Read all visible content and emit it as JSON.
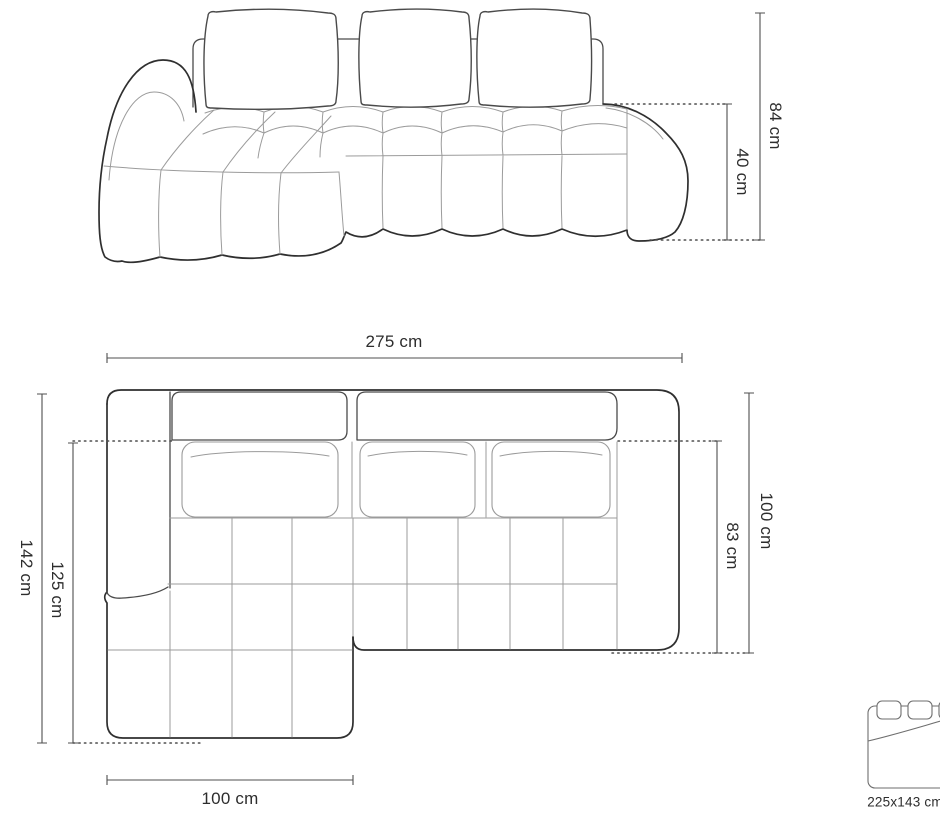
{
  "page": {
    "title": "Corner sofa dimensions diagram"
  },
  "colors": {
    "c-outline": "#2f2f2f",
    "c-outline-soft": "#4a4a4a",
    "c-seam": "#9b9b9b",
    "c-dim": "#4f4f4f",
    "c-text": "#2d2d2d",
    "c-bg": "#ffffff"
  },
  "front_view": {
    "name": "front-elevation-drawing",
    "dim_height_total": "84 cm",
    "dim_seat_height": "40 cm"
  },
  "top_view": {
    "name": "top-plan-drawing",
    "dim_width_total": "275 cm",
    "dim_depth_total": "142 cm",
    "dim_depth_chaise": "125 cm",
    "dim_depth_right": "100 cm",
    "dim_seat_depth": "83 cm",
    "dim_chaise_width": "100 cm"
  },
  "sleeping_area": {
    "icon": "bed-icon",
    "label": "225x143 cm"
  }
}
